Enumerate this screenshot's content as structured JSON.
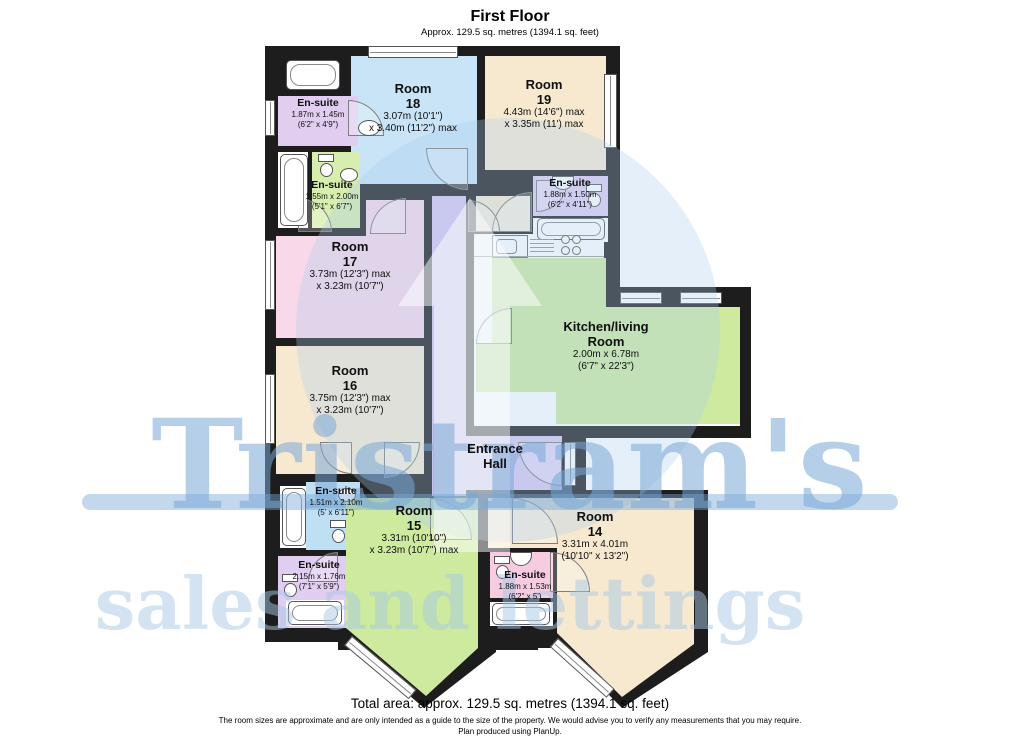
{
  "header": {
    "heading": "First Floor",
    "subheading": "Approx. 129.5 sq. metres (1394.1 sq. feet)"
  },
  "plan": {
    "wall_color": "#1d1d1d",
    "rooms": [
      {
        "id": "room-18",
        "name": "Room",
        "number": "18",
        "dim1": "3.07m (10'1\")",
        "dim2": "x 3.40m (11'2\") max",
        "color": "#c8e4f6"
      },
      {
        "id": "room-19",
        "name": "Room",
        "number": "19",
        "dim1": "4.43m (14'6\") max",
        "dim2": "x 3.35m (11') max",
        "color": "#f6e9d0"
      },
      {
        "id": "room-17",
        "name": "Room",
        "number": "17",
        "dim1": "3.73m (12'3\") max",
        "dim2": "x 3.23m (10'7\")",
        "color": "#f8d8e9"
      },
      {
        "id": "room-16",
        "name": "Room",
        "number": "16",
        "dim1": "3.75m (12'3\") max",
        "dim2": "x 3.23m (10'7\")",
        "color": "#f6e9d0"
      },
      {
        "id": "room-15",
        "name": "Room",
        "number": "15",
        "dim1": "3.31m (10'10\")",
        "dim2": "x 3.23m (10'7\") max",
        "color": "#cdea9f"
      },
      {
        "id": "room-14",
        "name": "Room",
        "number": "14",
        "dim1": "3.31m x 4.01m",
        "dim2": "(10'10\" x 13'2\")",
        "color": "#f6e9d0"
      },
      {
        "id": "kitchen-living-room",
        "name": "Kitchen/living",
        "number": "Room",
        "dim1": "2.00m x 6.78m",
        "dim2": "(6'7\" x 22'3\")",
        "color": "#cdea9f"
      },
      {
        "id": "entrance-hall",
        "name": "Entrance",
        "number": "Hall",
        "dim1": "",
        "dim2": "",
        "color": "#d7c6f0"
      }
    ],
    "ensuites": [
      {
        "id": "ensuite-top-left",
        "name": "En-suite",
        "dim1": "1.87m x 1.45m",
        "dim2": "(6'2\" x 4'9\")",
        "color": "#e0cdf0"
      },
      {
        "id": "ensuite-mid-left",
        "name": "En-suite",
        "dim1": "1.55m x 2.00m",
        "dim2": "(5'1\" x 6'7\")",
        "color": "#d8eeae"
      },
      {
        "id": "ensuite-right",
        "name": "En-suite",
        "dim1": "1.88m x 1.50m",
        "dim2": "(6'2\" x 4'11\")",
        "color": "#e0cdf0"
      },
      {
        "id": "ensuite-lower-left-blue",
        "name": "En-suite",
        "dim1": "1.51m x 2.10m",
        "dim2": "(5' x 6'11\")",
        "color": "#bfe0f4"
      },
      {
        "id": "ensuite-lower-left-purple",
        "name": "En-suite",
        "dim1": "2.15m x 1.76m",
        "dim2": "(7'1\" x 5'9\")",
        "color": "#e0cdf0"
      },
      {
        "id": "ensuite-bottom-pink",
        "name": "En-suite",
        "dim1": "1.88m x 1.53m",
        "dim2": "(6'2\" x 5')",
        "color": "#f7cce1"
      }
    ]
  },
  "watermark": {
    "brand": "Tristram's",
    "tagline": "sales and lettings",
    "brand_color": "#7aa8d7"
  },
  "footer": {
    "total": "Total area: approx. 129.5 sq. metres (1394.1 sq. feet)",
    "disclaimer": "The room sizes are approximate and are only intended as a guide to the size of the property. We would advise you to verify any measurements that you may require.",
    "produced": "Plan produced using PlanUp."
  }
}
